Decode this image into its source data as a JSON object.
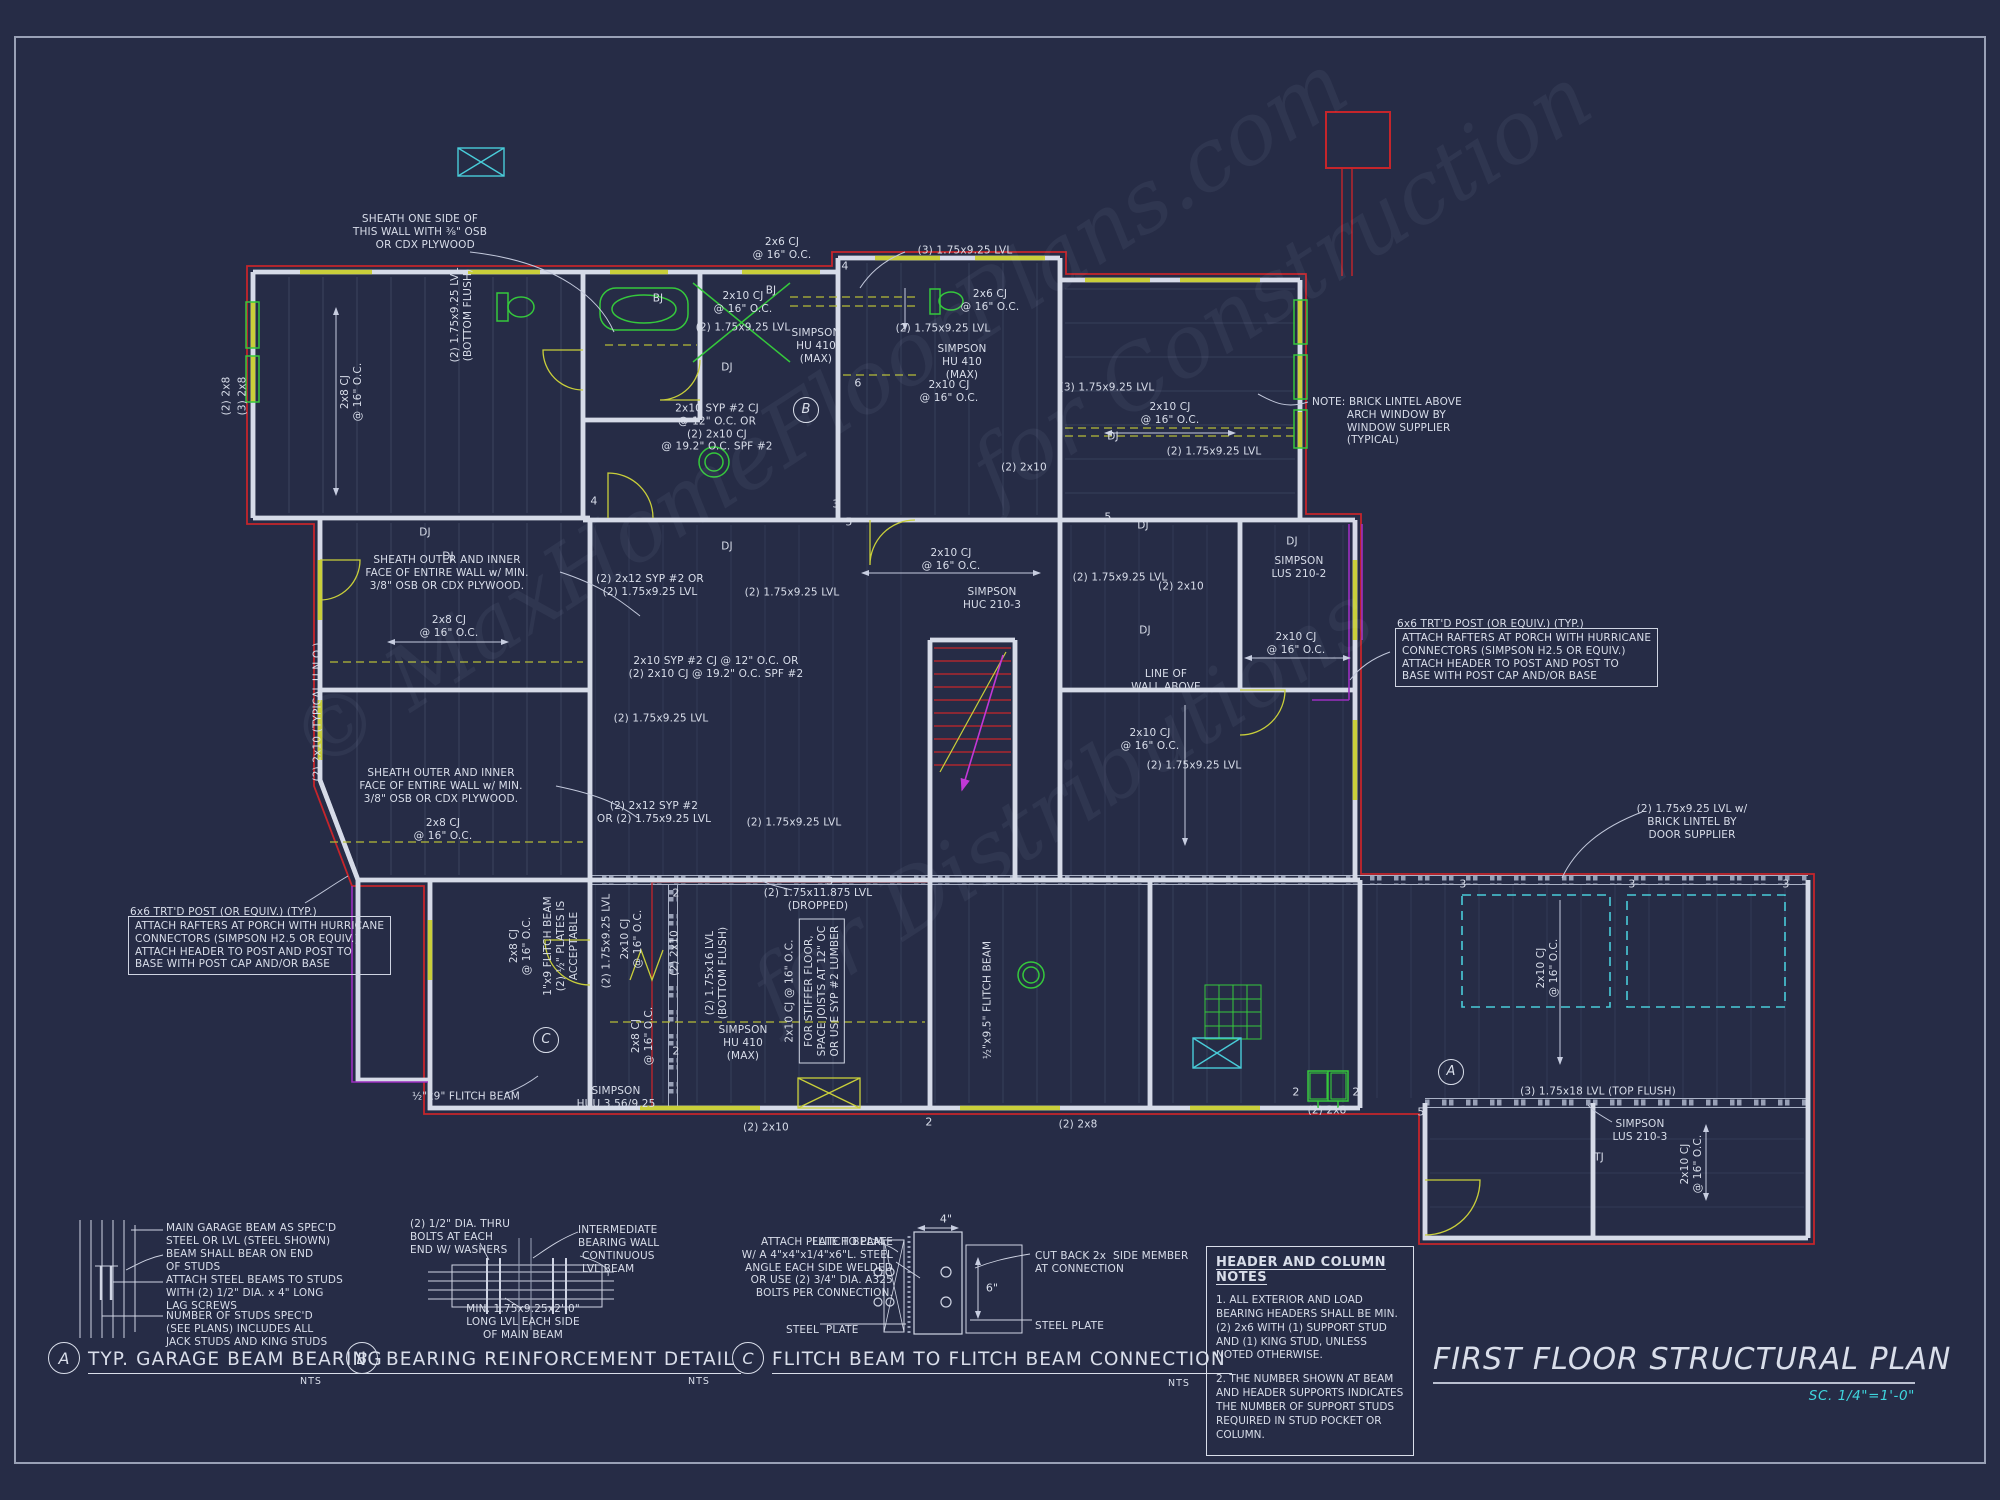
{
  "colors": {
    "background": "#262c46",
    "line_white": "#d6dbe8",
    "line_gray": "#8e96ac",
    "accent_red": "#c5252b",
    "accent_yellow": "#c9cf3a",
    "accent_olive": "#b6bd36",
    "accent_green": "#35c83c",
    "accent_cyan": "#49ccd9",
    "accent_magenta": "#c238d6",
    "accent_purple": "#9b2fc0",
    "text": "#d9deea",
    "scale_cyan": "#3fd6de"
  },
  "title_block": {
    "title": "FIRST FLOOR STRUCTURAL PLAN",
    "scale": "SC. 1/4\"=1'-0\""
  },
  "notes_box": {
    "title": "HEADER AND COLUMN NOTES",
    "notes": [
      "1. ALL EXTERIOR AND LOAD BEARING HEADERS SHALL BE MIN. (2) 2x6 WITH (1) SUPPORT STUD AND (1) KING STUD, UNLESS NOTED OTHERWISE.",
      "2. THE NUMBER SHOWN AT BEAM AND HEADER SUPPORTS INDICATES THE NUMBER OF SUPPORT STUDS REQUIRED IN STUD POCKET OR COLUMN."
    ]
  },
  "details": {
    "a": {
      "tag": "A",
      "title": "TYP. GARAGE BEAM BEARING",
      "nts": "NTS"
    },
    "b": {
      "tag": "B",
      "title": "BEARING REINFORCEMENT DETAIL",
      "nts": "NTS"
    },
    "c": {
      "tag": "C",
      "title": "FLITCH BEAM TO FLITCH BEAM CONNECTION",
      "nts": "NTS"
    }
  },
  "watermark": {
    "lines": [
      "© MaxHomeFloorPlans.com",
      "for Construction",
      "for Distributions"
    ]
  },
  "plan": {
    "labels": [
      {
        "t": "SHEATH ONE SIDE OF\nTHIS WALL WITH ⅜\" OSB\n   OR CDX PLYWOOD",
        "x": 420,
        "y": 232
      },
      {
        "t": "2x6 CJ\n@ 16\" O.C.",
        "x": 782,
        "y": 249
      },
      {
        "t": "(3) 1.75x9.25 LVL",
        "x": 965,
        "y": 251
      },
      {
        "t": "2x10 CJ\n@ 16\" O.C.",
        "x": 743,
        "y": 303
      },
      {
        "t": "(2) 1.75x9.25 LVL",
        "x": 743,
        "y": 328
      },
      {
        "t": "SIMPSON\nHU 410\n(MAX)",
        "x": 816,
        "y": 346
      },
      {
        "t": "2x6 CJ\n@ 16\" O.C.",
        "x": 990,
        "y": 301
      },
      {
        "t": "(2) 1.75x9.25 LVL",
        "x": 943,
        "y": 329
      },
      {
        "t": "SIMPSON\nHU 410\n(MAX)",
        "x": 962,
        "y": 362
      },
      {
        "t": "2x10 CJ\n@ 16\" O.C.",
        "x": 949,
        "y": 392
      },
      {
        "t": "(3) 1.75x9.25 LVL",
        "x": 1107,
        "y": 388
      },
      {
        "t": "2x10 CJ\n@ 16\" O.C.",
        "x": 1170,
        "y": 414
      },
      {
        "t": "(2) 1.75x9.25 LVL",
        "x": 1214,
        "y": 452
      },
      {
        "t": "NOTE: BRICK LINTEL ABOVE\n          ARCH WINDOW BY\n          WINDOW SUPPLIER\n          (TYPICAL)",
        "x": 1312,
        "y": 396,
        "a": "l"
      },
      {
        "t": "2x10 SYP #2 CJ\n@ 12\" O.C. OR\n(2) 2x10 CJ\n@ 19.2\" O.C. SPF #2",
        "x": 717,
        "y": 428
      },
      {
        "t": "(2) 2x10",
        "x": 1024,
        "y": 468
      },
      {
        "t": "(2) 2x12 SYP #2 OR\n(2) 1.75x9.25 LVL",
        "x": 650,
        "y": 586
      },
      {
        "t": "(2) 1.75x9.25 LVL",
        "x": 792,
        "y": 593
      },
      {
        "t": "SHEATH OUTER AND INNER\nFACE OF ENTIRE WALL w/ MIN.\n3/8\" OSB OR CDX PLYWOOD.",
        "x": 447,
        "y": 573
      },
      {
        "t": "2x8 CJ\n@ 16\" O.C.",
        "x": 449,
        "y": 627
      },
      {
        "t": "2x10 SYP #2 CJ @ 12\" O.C. OR\n(2) 2x10 CJ @ 19.2\" O.C. SPF #2",
        "x": 716,
        "y": 668
      },
      {
        "t": "(2) 1.75x9.25 LVL",
        "x": 661,
        "y": 719
      },
      {
        "t": "2x10 CJ\n@ 16\" O.C.",
        "x": 951,
        "y": 560
      },
      {
        "t": "SIMPSON\nHUC 210-3",
        "x": 992,
        "y": 599
      },
      {
        "t": "(2) 1.75x9.25 LVL",
        "x": 1120,
        "y": 578
      },
      {
        "t": "DJ",
        "x": 425,
        "y": 533
      },
      {
        "t": "DJ",
        "x": 448,
        "y": 557
      },
      {
        "t": "DJ",
        "x": 727,
        "y": 368
      },
      {
        "t": "DJ",
        "x": 727,
        "y": 547
      },
      {
        "t": "DJ",
        "x": 1143,
        "y": 526
      },
      {
        "t": "DJ",
        "x": 1292,
        "y": 542
      },
      {
        "t": "DJ",
        "x": 1145,
        "y": 631
      },
      {
        "t": "DJ",
        "x": 1113,
        "y": 437
      },
      {
        "t": "BJ",
        "x": 658,
        "y": 299
      },
      {
        "t": "BJ",
        "x": 771,
        "y": 291
      },
      {
        "t": "SIMPSON\nLUS 210-2",
        "x": 1299,
        "y": 568
      },
      {
        "t": "(2) 2x10",
        "x": 1181,
        "y": 587
      },
      {
        "t": "2x10 CJ\n@ 16\" O.C.",
        "x": 1296,
        "y": 644
      },
      {
        "t": "LINE OF\nWALL ABOVE",
        "x": 1166,
        "y": 681
      },
      {
        "t": "6x6 TRT'D POST (OR EQUIV.) (TYP.)",
        "x": 1397,
        "y": 618,
        "a": "l"
      },
      {
        "t": "ATTACH RAFTERS AT PORCH WITH HURRICANE\nCONNECTORS (SIMPSON H2.5 OR EQUIV.)\nATTACH HEADER TO POST AND POST TO\nBASE WITH POST CAP AND/OR BASE",
        "x": 1395,
        "y": 628,
        "a": "l",
        "box": true
      },
      {
        "t": "2x10 CJ\n@ 16\" O.C.",
        "x": 1150,
        "y": 740
      },
      {
        "t": "(2) 1.75x9.25 LVL",
        "x": 1194,
        "y": 766
      },
      {
        "t": "SHEATH OUTER AND INNER\nFACE OF ENTIRE WALL w/ MIN.\n3/8\" OSB OR CDX PLYWOOD.",
        "x": 441,
        "y": 786
      },
      {
        "t": "(2) 2x12 SYP #2\nOR (2) 1.75x9.25 LVL",
        "x": 654,
        "y": 813
      },
      {
        "t": "2x8 CJ\n@ 16\" O.C.",
        "x": 443,
        "y": 830
      },
      {
        "t": "(2) 1.75x9.25 LVL",
        "x": 794,
        "y": 823
      },
      {
        "t": "(2) 2x10 (TYPICAL U.N.O.)",
        "x": 318,
        "y": 712,
        "r": -90
      },
      {
        "t": "(2) 2x8",
        "x": 227,
        "y": 396,
        "r": -90
      },
      {
        "t": "(3) 2x8",
        "x": 243,
        "y": 396,
        "r": -90
      },
      {
        "t": "2x8 CJ\n@ 16\" O.C.",
        "x": 352,
        "y": 392,
        "r": -90
      },
      {
        "t": "(2) 1.75x9.25 LVL\n(BOTTOM FLUSH)",
        "x": 462,
        "y": 315,
        "r": -90
      },
      {
        "t": "6x6 TRT'D POST (OR EQUIV.) (TYP.)",
        "x": 130,
        "y": 906,
        "a": "l"
      },
      {
        "t": "ATTACH RAFTERS AT PORCH WITH HURRICANE\nCONNECTORS (SIMPSON H2.5 OR EQUIV.)\nATTACH HEADER TO POST AND POST TO\nBASE WITH POST CAP AND/OR BASE",
        "x": 128,
        "y": 916,
        "a": "l",
        "box": true
      },
      {
        "t": "(2) 1.75x11.875 LVL\n(DROPPED)",
        "x": 818,
        "y": 900
      },
      {
        "t": "2x8 CJ\n@ 16\" O.C.",
        "x": 521,
        "y": 946,
        "r": -90
      },
      {
        "t": "1\"x9 FLITCH BEAM\n(2) ½\" PLATES IS\nACCEPTABLE",
        "x": 561,
        "y": 946,
        "r": -90
      },
      {
        "t": "(2) 1.75x9.25 LVL",
        "x": 607,
        "y": 941,
        "r": -90
      },
      {
        "t": "2x10 CJ\n@ 16\" O.C.",
        "x": 632,
        "y": 939,
        "r": -90
      },
      {
        "t": "(2) 2x10",
        "x": 675,
        "y": 953,
        "r": -90
      },
      {
        "t": "(2) 1.75x16 LVL\n(BOTTOM FLUSH)",
        "x": 717,
        "y": 973,
        "r": -90
      },
      {
        "t": "2x8 CJ\n@ 16\" O.C.",
        "x": 643,
        "y": 1036,
        "r": -90
      },
      {
        "t": "SIMPSON\nHU 410\n(MAX)",
        "x": 743,
        "y": 1043
      },
      {
        "t": "2x10 CJ @ 16\" O.C.",
        "x": 790,
        "y": 991,
        "r": -90
      },
      {
        "t": "FOR STIFFER FLOOR,\nSPACE JOISTS AT 12\" OC\nOR USE SYP #2 LUMBER",
        "x": 822,
        "y": 991,
        "r": -90,
        "box": true
      },
      {
        "t": "SIMPSON\nHUU 3.56/9.25",
        "x": 616,
        "y": 1098
      },
      {
        "t": "½\"x9\" FLITCH BEAM",
        "x": 466,
        "y": 1097
      },
      {
        "t": "½\"x9.5\" FLITCH BEAM",
        "x": 988,
        "y": 1000,
        "r": -90
      },
      {
        "t": "(2) 2x10",
        "x": 766,
        "y": 1128
      },
      {
        "t": "(2) 2x8",
        "x": 1078,
        "y": 1125
      },
      {
        "t": "(2) 2x8",
        "x": 1327,
        "y": 1111
      },
      {
        "t": "(3) 1.75x18 LVL (TOP FLUSH)",
        "x": 1598,
        "y": 1092
      },
      {
        "t": "SIMPSON\nLUS 210-3",
        "x": 1640,
        "y": 1131
      },
      {
        "t": "TJ",
        "x": 1599,
        "y": 1158
      },
      {
        "t": "2x10 CJ\n@ 16\" O.C.",
        "x": 1692,
        "y": 1164,
        "r": -90
      },
      {
        "t": "(2) 1.75x9.25 LVL w/\nBRICK LINTEL BY\nDOOR SUPPLIER",
        "x": 1692,
        "y": 822
      },
      {
        "t": "2x10 CJ\n@ 16\" O.C.",
        "x": 1548,
        "y": 968,
        "r": -90
      },
      {
        "t": "4",
        "x": 845,
        "y": 266,
        "cls": "num"
      },
      {
        "t": "6",
        "x": 858,
        "y": 383,
        "cls": "num"
      },
      {
        "t": "3",
        "x": 836,
        "y": 504,
        "cls": "num"
      },
      {
        "t": "5",
        "x": 849,
        "y": 522,
        "cls": "num"
      },
      {
        "t": "4",
        "x": 594,
        "y": 501,
        "cls": "num"
      },
      {
        "t": "5",
        "x": 1108,
        "y": 517,
        "cls": "num"
      },
      {
        "t": "3",
        "x": 830,
        "y": 881,
        "cls": "num"
      },
      {
        "t": "2",
        "x": 676,
        "y": 893,
        "cls": "num"
      },
      {
        "t": "2",
        "x": 676,
        "y": 1051,
        "cls": "num"
      },
      {
        "t": "2",
        "x": 1296,
        "y": 1092,
        "cls": "num"
      },
      {
        "t": "2",
        "x": 1356,
        "y": 1092,
        "cls": "num"
      },
      {
        "t": "5",
        "x": 1421,
        "y": 1112,
        "cls": "num"
      },
      {
        "t": "3",
        "x": 1463,
        "y": 884,
        "cls": "num"
      },
      {
        "t": "3",
        "x": 1632,
        "y": 884,
        "cls": "num"
      },
      {
        "t": "3",
        "x": 1786,
        "y": 884,
        "cls": "num"
      },
      {
        "t": "2",
        "x": 929,
        "y": 1122,
        "cls": "num"
      },
      {
        "t": "A",
        "x": 1451,
        "y": 1072,
        "cls": "circ"
      },
      {
        "t": "B",
        "x": 806,
        "y": 410,
        "cls": "circ"
      },
      {
        "t": "C",
        "x": 546,
        "y": 1040,
        "cls": "circ"
      },
      {
        "t": "MAIN GARAGE BEAM AS SPEC'D\nSTEEL OR LVL (STEEL SHOWN)",
        "x": 166,
        "y": 1222,
        "a": "l"
      },
      {
        "t": "BEAM SHALL BEAR ON END\nOF STUDS",
        "x": 166,
        "y": 1248,
        "a": "l"
      },
      {
        "t": "ATTACH STEEL BEAMS TO STUDS\nWITH (2) 1/2\" DIA. x 4\" LONG\nLAG SCREWS",
        "x": 166,
        "y": 1274,
        "a": "l"
      },
      {
        "t": "NUMBER OF STUDS SPEC'D\n(SEE PLANS) INCLUDES ALL\nJACK STUDS AND KING STUDS",
        "x": 166,
        "y": 1310,
        "a": "l"
      },
      {
        "t": "(2) 1/2\" DIA. THRU\nBOLTS AT EACH\nEND W/ WASHERS",
        "x": 410,
        "y": 1218,
        "a": "l"
      },
      {
        "t": "INTERMEDIATE\nBEARING WALL",
        "x": 578,
        "y": 1224,
        "a": "l"
      },
      {
        "t": "CONTINUOUS\nLVL BEAM",
        "x": 582,
        "y": 1250,
        "a": "l"
      },
      {
        "t": "MIN. 1.75x9.25x2'-0\"\nLONG LVL EACH SIDE\nOF MAIN BEAM",
        "x": 523,
        "y": 1322
      },
      {
        "t": "FLITCH BEAM",
        "x": 812,
        "y": 1236,
        "a": "l"
      },
      {
        "t": "ATTACH PLATE TO PLATE\nW/ A 4\"x4\"x1/4\"x6\"L. STEEL\nANGLE EACH SIDE WELDED\nOR USE (2) 3/4\" DIA. A325\nBOLTS PER CONNECTION.",
        "x": 893,
        "y": 1268,
        "a": "r"
      },
      {
        "t": "STEEL  PLATE",
        "x": 786,
        "y": 1324,
        "a": "l"
      },
      {
        "t": "CUT BACK 2x  SIDE MEMBER\nAT CONNECTION",
        "x": 1035,
        "y": 1250,
        "a": "l"
      },
      {
        "t": "STEEL PLATE",
        "x": 1035,
        "y": 1320,
        "a": "l"
      },
      {
        "t": "4\"",
        "x": 946,
        "y": 1219,
        "cls": "num"
      },
      {
        "t": "6\"",
        "x": 992,
        "y": 1288,
        "cls": "num"
      }
    ]
  }
}
